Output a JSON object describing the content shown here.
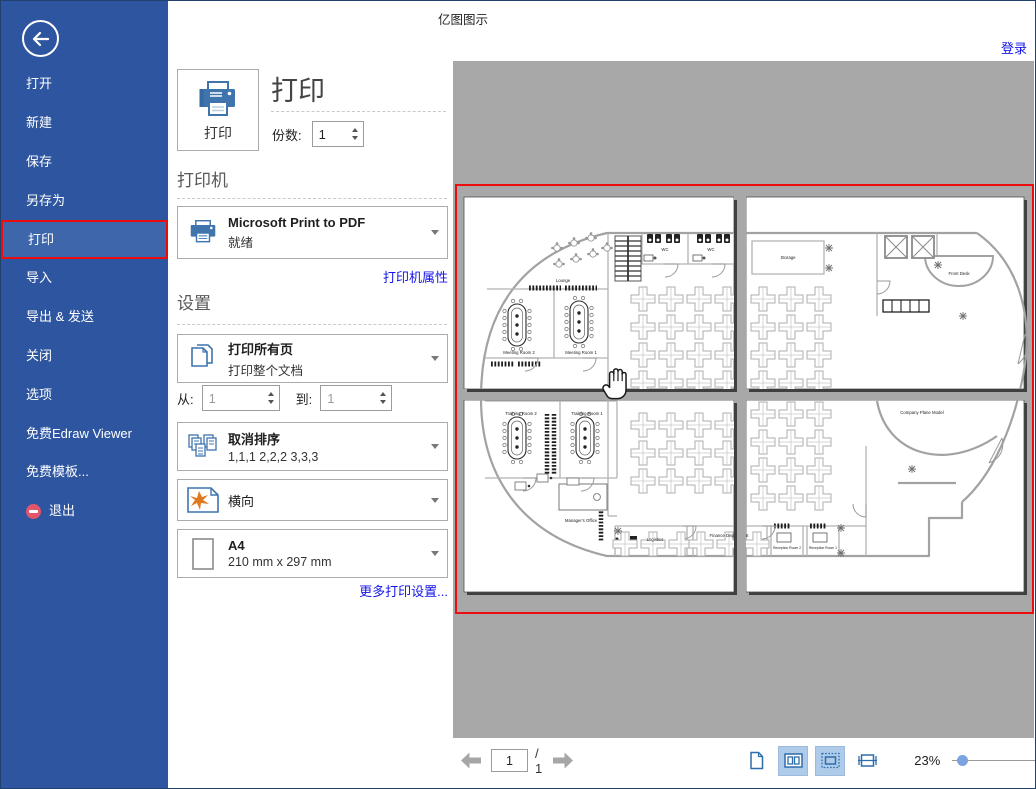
{
  "window": {
    "title": "亿图图示",
    "login_label": "登录"
  },
  "sidebar": {
    "items": [
      {
        "label": "打开"
      },
      {
        "label": "新建"
      },
      {
        "label": "保存"
      },
      {
        "label": "另存为"
      },
      {
        "label": "打印",
        "selected": true
      },
      {
        "label": "导入"
      },
      {
        "label": "导出 & 发送"
      },
      {
        "label": "关闭"
      },
      {
        "label": "选项"
      },
      {
        "label": "免费Edraw Viewer"
      },
      {
        "label": "免费模板..."
      },
      {
        "label": "退出"
      }
    ]
  },
  "print_panel": {
    "title": "打印",
    "print_button_label": "打印",
    "copies_label": "份数:",
    "copies_value": "1",
    "printer_section_title": "打印机",
    "printer_name": "Microsoft Print to PDF",
    "printer_status": "就绪",
    "printer_properties_link": "打印机属性",
    "settings_section_title": "设置",
    "range_title": "打印所有页",
    "range_subtitle": "打印整个文档",
    "from_label": "从:",
    "from_value": "1",
    "to_label": "到:",
    "to_value": "1",
    "collate_title": "取消排序",
    "collate_subtitle": "1,1,1  2,2,2  3,3,3",
    "orientation_label": "横向",
    "paper_title": "A4",
    "paper_subtitle": "210 mm x 297 mm",
    "more_settings_link": "更多打印设置..."
  },
  "preview": {
    "page_value": "1",
    "page_total_label": "/ 1",
    "zoom_percent": "23%",
    "floorplan_labels": [
      "Lounge",
      "WC",
      "WC",
      "Meeting Room 2",
      "Meeting Room 1",
      "Storage",
      "Front Desk",
      "Training Room 2",
      "Training Room 1",
      "Manager's Office",
      "Logistics",
      "Finance Department",
      "Company Plane Model",
      "Reception Room 2",
      "Reception Room 1"
    ]
  },
  "colors": {
    "sidebar-blue": "#2e56a0",
    "sidebar-selected": "#3d66ab",
    "accent-red": "#ee0d0d",
    "link-blue": "#1414e8",
    "icon-blue": "#2e6dab",
    "toggle-bg": "#aecbea",
    "preview-gray": "#a8a8a8",
    "exit-pink": "#e2556a",
    "slider-thumb": "#7aa3e0"
  }
}
